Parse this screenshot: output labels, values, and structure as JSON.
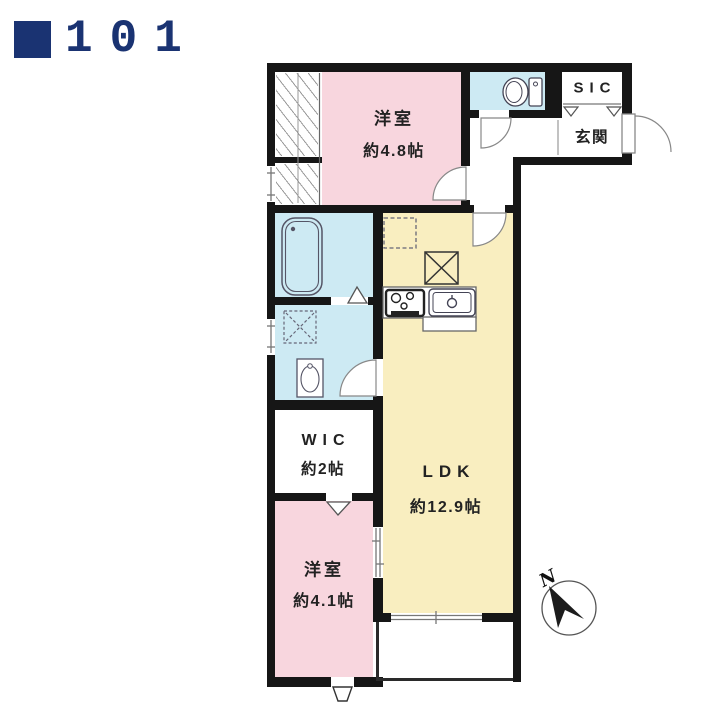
{
  "header": {
    "unit_number": "101"
  },
  "colors": {
    "navy": "#1a3372",
    "bedroom_pink": "#f8d6de",
    "ldk_yellow": "#f9eec0",
    "wet_area_blue": "#cdeaf3",
    "wall": "#161616"
  },
  "rooms": {
    "bedroom1": {
      "name": "洋室",
      "size": "約4.8帖"
    },
    "ldk": {
      "name": "LDK",
      "size": "約12.9帖"
    },
    "wic": {
      "name": "WIC",
      "size": "約2帖"
    },
    "bedroom2": {
      "name": "洋室",
      "size": "約4.1帖"
    },
    "entrance": {
      "name": "玄関"
    },
    "shoe_closet": {
      "name": "SIC"
    }
  },
  "compass": {
    "north_label": "N"
  }
}
